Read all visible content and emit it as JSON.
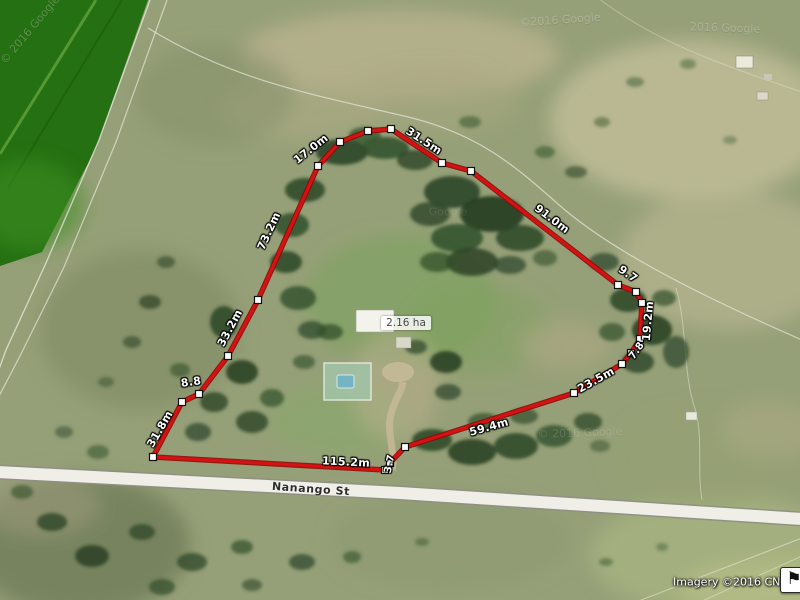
{
  "map": {
    "measurements": [
      "17.0m",
      "31.5m",
      "91.0m",
      "9.7",
      "19.2m",
      "7.8",
      "23.5m",
      "59.4m",
      "3.7",
      "115.2m",
      "31.8m",
      "8.8",
      "33.2m",
      "73.2m"
    ],
    "area_label": "2.16 ha",
    "street_label": "Nanango St",
    "attribution": "Imagery ©2016 CNES / A",
    "watermarks": [
      "© 2016 Google",
      "©2016 Google",
      "2016 Google",
      "Google",
      "© 2016 Google"
    ],
    "icons": {
      "flag": "⚑"
    },
    "colors": {
      "measure_line": "#d51212",
      "vertex_fill": "#ffffff",
      "vertex_border": "#111111",
      "road_fill": "#efeee6",
      "crop_field_green": "#257012"
    }
  }
}
